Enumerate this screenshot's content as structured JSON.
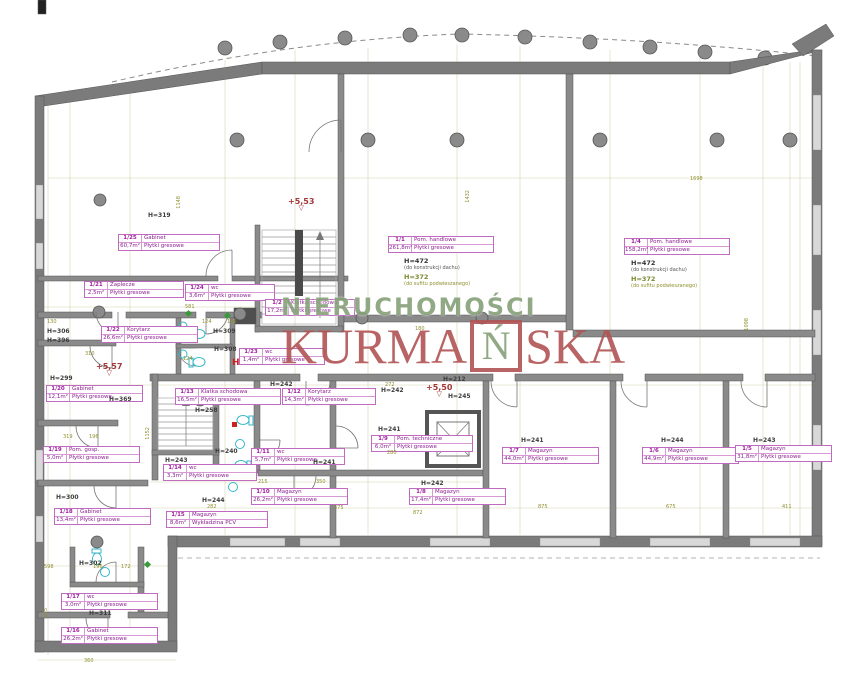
{
  "watermark": {
    "line1": "NIERUCHOMOŚCI",
    "kurma_pre": "KURMA",
    "kurma_n": "Ń",
    "kurma_post": "SKA"
  },
  "hydrant": {
    "t": "H",
    "x": 232,
    "y": 358
  },
  "levels": [
    {
      "t": "+5,53",
      "x": 288,
      "y": 198
    },
    {
      "t": "+5,57",
      "x": 96,
      "y": 363
    },
    {
      "t": "+5,50",
      "x": 426,
      "y": 384
    }
  ],
  "halls": [
    {
      "x": 404,
      "y": 258,
      "h1": "H=472",
      "n1": "(do konstrukcji dachu)",
      "h2": "H=372",
      "n2": "(do sufitu podwieszanego)"
    },
    {
      "x": 631,
      "y": 260,
      "h1": "H=472",
      "n1": "(do konstrukcji dachu)",
      "h2": "H=372",
      "n2": "(do sufitu podwieszanego)"
    }
  ],
  "rooms": [
    {
      "num": "1/25",
      "name": "Gabinet",
      "area": "60,7m²",
      "floor": "Płytki gresowe",
      "x": 118,
      "y": 234,
      "w": 100
    },
    {
      "num": "1/21",
      "name": "Zaplecze",
      "area": "2,5m²",
      "floor": "Płytki gresowe",
      "x": 84,
      "y": 281,
      "w": 98
    },
    {
      "num": "1/24",
      "name": "wc",
      "area": "3,6m²",
      "floor": "Płytki gresowe",
      "x": 185,
      "y": 284,
      "w": 88
    },
    {
      "num": "1/22",
      "name": "Korytarz",
      "area": "26,6m²",
      "floor": "Płytki gresowe",
      "x": 101,
      "y": 326,
      "w": 95
    },
    {
      "num": "1/23",
      "name": "wc",
      "area": "1,4m²",
      "floor": "Płytki gresowe",
      "x": 239,
      "y": 348,
      "w": 84
    },
    {
      "num": "1/2",
      "name": "Klatka schodowa",
      "area": "17,2m²",
      "floor": "Płytki gresowe",
      "x": 265,
      "y": 299,
      "w": 88
    },
    {
      "num": "1/1",
      "name": "Pom. handlowe",
      "area": "261,8m²",
      "floor": "Płytki gresowe",
      "x": 388,
      "y": 236,
      "w": 104
    },
    {
      "num": "1/4",
      "name": "Pom. handlowe",
      "area": "158,2m²",
      "floor": "Płytki gresowe",
      "x": 624,
      "y": 238,
      "w": 104
    },
    {
      "num": "1/20",
      "name": "Gabinet",
      "area": "12,1m²",
      "floor": "Płytki gresowe",
      "x": 46,
      "y": 385,
      "w": 95
    },
    {
      "num": "1/19",
      "name": "Pom. gosp.",
      "area": "5,0m²",
      "floor": "Płytki gresowe",
      "x": 43,
      "y": 446,
      "w": 95
    },
    {
      "num": "1/18",
      "name": "Gabinet",
      "area": "13,4m²",
      "floor": "Płytki gresowe",
      "x": 54,
      "y": 508,
      "w": 95
    },
    {
      "num": "1/17",
      "name": "wc",
      "area": "3,0m²",
      "floor": "Płytki gresowe",
      "x": 61,
      "y": 593,
      "w": 95
    },
    {
      "num": "1/16",
      "name": "Gabinet",
      "area": "26,2m²",
      "floor": "Płytki gresowe",
      "x": 61,
      "y": 627,
      "w": 95
    },
    {
      "num": "1/13",
      "name": "Klatka schodowa",
      "area": "16,5m²",
      "floor": "Płytki gresowe",
      "x": 175,
      "y": 388,
      "w": 104
    },
    {
      "num": "1/14",
      "name": "wc",
      "area": "3,3m²",
      "floor": "Płytki gresowe",
      "x": 163,
      "y": 464,
      "w": 92
    },
    {
      "num": "1/15",
      "name": "Magazyn",
      "area": "8,6m²",
      "floor": "Wykładzina PCV",
      "x": 166,
      "y": 511,
      "w": 100
    },
    {
      "num": "1/12",
      "name": "Korytarz",
      "area": "14,3m²",
      "floor": "Płytki gresowe",
      "x": 282,
      "y": 388,
      "w": 92
    },
    {
      "num": "1/11",
      "name": "wc",
      "area": "5,7m²",
      "floor": "Płytki gresowe",
      "x": 251,
      "y": 448,
      "w": 92
    },
    {
      "num": "1/10",
      "name": "Magazyn",
      "area": "26,2m²",
      "floor": "Płytki gresowe",
      "x": 251,
      "y": 488,
      "w": 95
    },
    {
      "num": "1/9",
      "name": "Pom. techniczne",
      "area": "6,0m²",
      "floor": "Płytki gresowe",
      "x": 371,
      "y": 435,
      "w": 100
    },
    {
      "num": "1/8",
      "name": "Magazyn",
      "area": "17,4m²",
      "floor": "Płytki gresowe",
      "x": 409,
      "y": 488,
      "w": 95
    },
    {
      "num": "1/7",
      "name": "Magazyn",
      "area": "44,0m²",
      "floor": "Płytki gresowe",
      "x": 502,
      "y": 447,
      "w": 95
    },
    {
      "num": "1/6",
      "name": "Magazyn",
      "area": "44,9m²",
      "floor": "Płytki gresowe",
      "x": 642,
      "y": 447,
      "w": 95
    },
    {
      "num": "1/5",
      "name": "Magazyn",
      "area": "31,8m²",
      "floor": "Płytki gresowe",
      "x": 735,
      "y": 445,
      "w": 95
    }
  ],
  "heights": [
    {
      "t": "H=319",
      "x": 148,
      "y": 212
    },
    {
      "t": "H=306",
      "x": 47,
      "y": 328
    },
    {
      "t": "H=396",
      "x": 47,
      "y": 337
    },
    {
      "t": "H=309",
      "x": 213,
      "y": 328
    },
    {
      "t": "H=308",
      "x": 214,
      "y": 346
    },
    {
      "t": "H=299",
      "x": 50,
      "y": 375
    },
    {
      "t": "H=369",
      "x": 109,
      "y": 396
    },
    {
      "t": "H=300",
      "x": 56,
      "y": 494
    },
    {
      "t": "H=302",
      "x": 79,
      "y": 560
    },
    {
      "t": "H=311",
      "x": 89,
      "y": 610
    },
    {
      "t": "H=258",
      "x": 195,
      "y": 407
    },
    {
      "t": "H=243",
      "x": 165,
      "y": 457
    },
    {
      "t": "H=240",
      "x": 215,
      "y": 448
    },
    {
      "t": "H=244",
      "x": 202,
      "y": 497
    },
    {
      "t": "H=242",
      "x": 270,
      "y": 381
    },
    {
      "t": "H=242",
      "x": 381,
      "y": 387
    },
    {
      "t": "H=241",
      "x": 378,
      "y": 426
    },
    {
      "t": "H=241",
      "x": 313,
      "y": 459
    },
    {
      "t": "H=242",
      "x": 421,
      "y": 480
    },
    {
      "t": "H=241",
      "x": 521,
      "y": 437
    },
    {
      "t": "H=244",
      "x": 661,
      "y": 437
    },
    {
      "t": "H=243",
      "x": 753,
      "y": 437
    },
    {
      "t": "H=245",
      "x": 448,
      "y": 393
    },
    {
      "t": "H=212",
      "x": 443,
      "y": 376
    }
  ],
  "dims": [
    {
      "t": "1148",
      "x": 176,
      "y": 196,
      "v": true
    },
    {
      "t": "1432",
      "x": 465,
      "y": 190,
      "v": true
    },
    {
      "t": "1698",
      "x": 690,
      "y": 176
    },
    {
      "t": "1098",
      "x": 744,
      "y": 318,
      "v": true
    },
    {
      "t": "581",
      "x": 185,
      "y": 304
    },
    {
      "t": "130",
      "x": 47,
      "y": 319
    },
    {
      "t": "124",
      "x": 202,
      "y": 319
    },
    {
      "t": "136",
      "x": 227,
      "y": 319
    },
    {
      "t": "124",
      "x": 183,
      "y": 356
    },
    {
      "t": "180",
      "x": 415,
      "y": 326
    },
    {
      "t": "310",
      "x": 85,
      "y": 351
    },
    {
      "t": "319",
      "x": 63,
      "y": 434
    },
    {
      "t": "196",
      "x": 89,
      "y": 434
    },
    {
      "t": "1152",
      "x": 145,
      "y": 427,
      "v": true
    },
    {
      "t": "272",
      "x": 385,
      "y": 382
    },
    {
      "t": "280",
      "x": 387,
      "y": 450
    },
    {
      "t": "215",
      "x": 258,
      "y": 479
    },
    {
      "t": "350",
      "x": 316,
      "y": 479
    },
    {
      "t": "282",
      "x": 207,
      "y": 504
    },
    {
      "t": "575",
      "x": 334,
      "y": 505
    },
    {
      "t": "872",
      "x": 413,
      "y": 510
    },
    {
      "t": "875",
      "x": 538,
      "y": 504
    },
    {
      "t": "675",
      "x": 666,
      "y": 504
    },
    {
      "t": "411",
      "x": 782,
      "y": 504
    },
    {
      "t": "598",
      "x": 44,
      "y": 564
    },
    {
      "t": "196",
      "x": 93,
      "y": 564
    },
    {
      "t": "172",
      "x": 121,
      "y": 564
    },
    {
      "t": "275",
      "x": 43,
      "y": 608,
      "v": true
    },
    {
      "t": "360",
      "x": 84,
      "y": 658
    }
  ]
}
